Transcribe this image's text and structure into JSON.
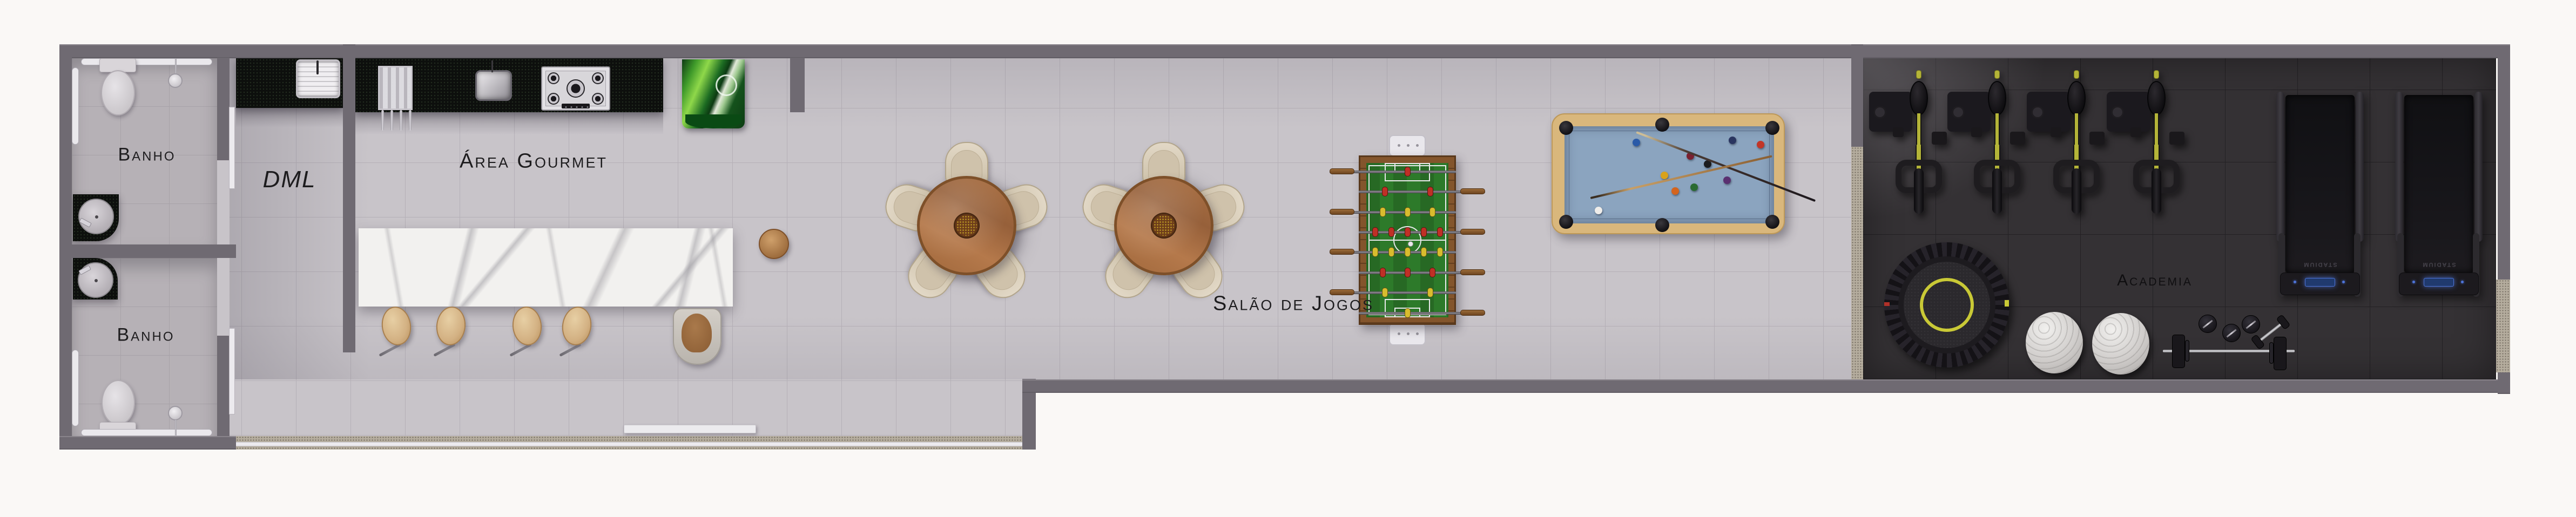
{
  "plan_title": "Floor plan - condominium leisure area",
  "rooms": {
    "banho_top": {
      "label": "Banho"
    },
    "banho_bottom": {
      "label": "Banho"
    },
    "dml": {
      "label": "DML"
    },
    "area_gourmet": {
      "label": "Área Gourmet"
    },
    "salao_de_jogos": {
      "label": "Salão de Jogos"
    },
    "academia": {
      "label": "Academia"
    }
  },
  "equipment": {
    "treadmill_brand": "STADIUM",
    "spin_bike_count": 4,
    "treadmill_count": 2,
    "dining_table_count": 2,
    "chairs_per_table": 5,
    "bar_stool_count": 4,
    "bathroom_count": 2
  },
  "colors": {
    "wall": "#6f6a72",
    "floor_main": "#c8c4c9",
    "floor_bath": "#b6b1b6",
    "floor_gym": "#343134",
    "granite_dark": "#0d0f0d",
    "granite_sill": "#b5ad9e",
    "marble": "#f2f1ef",
    "field_green": "#2d7a2a",
    "felt_blue": "#8ba4bf",
    "pool_wood": "#d9b77c",
    "accent_yellow": "#b4b438",
    "label": "#1d1c1e"
  }
}
